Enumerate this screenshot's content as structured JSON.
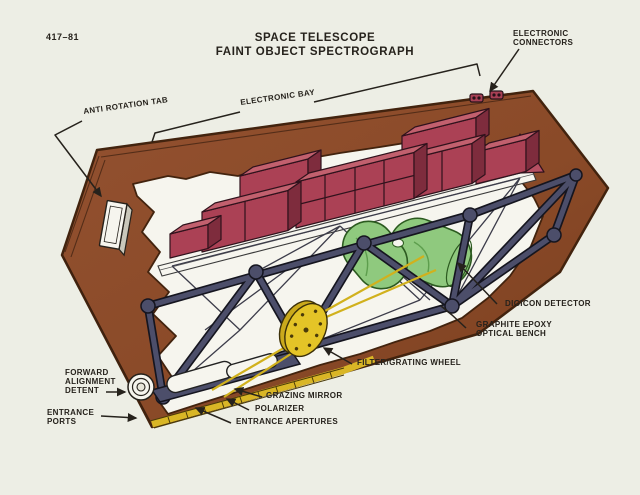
{
  "figure_number": "417–81",
  "title": {
    "line1": "SPACE TELESCOPE",
    "line2": "FAINT OBJECT SPECTROGRAPH"
  },
  "labels": {
    "anti_rotation_tab": "ANTI ROTATION TAB",
    "electronic_bay": "ELECTRONIC BAY",
    "electronic_connectors": [
      "ELECTRONIC",
      "CONNECTORS"
    ],
    "digicon_detector": "DIGICON DETECTOR",
    "graphite_epoxy_optical_bench": [
      "GRAPHITE EPOXY",
      "OPTICAL BENCH"
    ],
    "filter_grating_wheel": "FILTER/GRATING WHEEL",
    "grazing_mirror": "GRAZING MIRROR",
    "polarizer": "POLARIZER",
    "entrance_apertures": "ENTRANCE APERTURES",
    "forward_alignment_detent": [
      "FORWARD",
      "ALIGNMENT",
      "DETENT"
    ],
    "entrance_ports": [
      "ENTRANCE",
      "PORTS"
    ]
  },
  "colors": {
    "background": "#edeee5",
    "interior_white": "#f6f5ee",
    "housing_brown": "#8a4a28",
    "electronics_maroon": "#ab4155",
    "truss_blue": "#4c4e6a",
    "detector_green": "#8fc97e",
    "wheel_yellow": "#e4c427",
    "aperture_strip_yellow": "#d9b626",
    "ink": "#26221c"
  }
}
